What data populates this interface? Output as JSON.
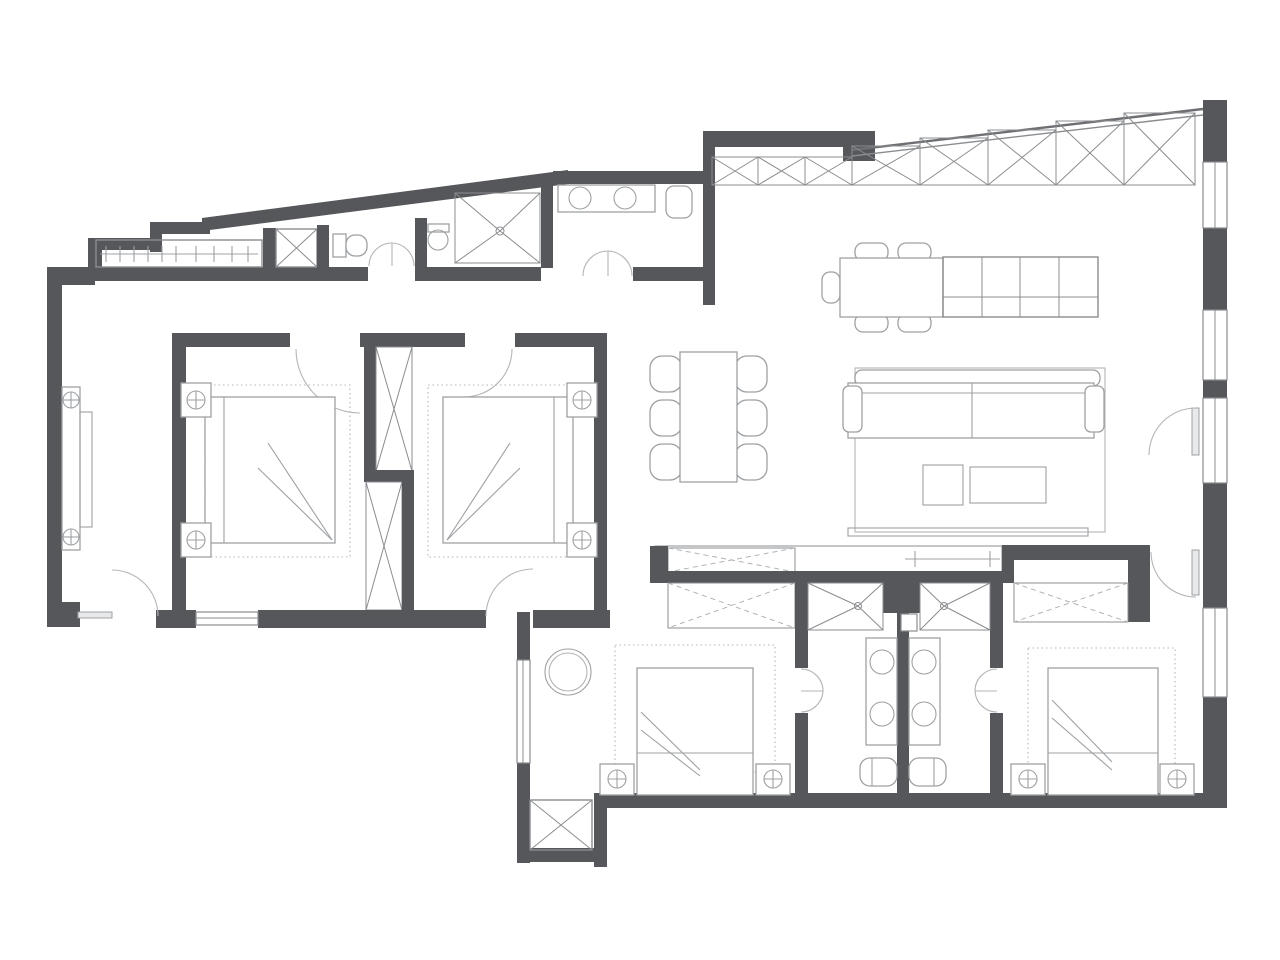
{
  "image": {
    "kind": "architectural-floor-plan",
    "width_px": 1280,
    "height_px": 960,
    "style": "black-and-white line drawing, top-down apartment plan, no text labels"
  },
  "colors": {
    "bg": "#ffffff",
    "wall": "#56575b",
    "line": "#8a8c8f",
    "furn": "#9da0a3",
    "faint": "#b3b5b8",
    "dash": "#b0b2b5"
  },
  "elements": {
    "rooms": [
      "entry-hall-with-coat-closet",
      "utility-shaft",
      "guest-wc",
      "shower-room",
      "top-bathroom",
      "open-kitchen-living-dining-area",
      "bedroom-1-left",
      "bedroom-2-left",
      "wardrobe-corridor",
      "ensuite-bathroom-left",
      "ensuite-bathroom-right",
      "bedroom-bottom-left",
      "bedroom-bottom-right",
      "ac-platform"
    ],
    "furniture_symbols": [
      "coat-rail-with-hangers",
      "shaft-x-box",
      "toilet",
      "wall-basin",
      "shower-with-fan-lines",
      "double-basin-vanity",
      "kitchen-wall-cabinets-x-cells",
      "kitchen-island-grid",
      "kitchen-table-with-chairs",
      "dining-table-six-chairs",
      "three-seat-sofa",
      "rug",
      "coffee-tables",
      "tv-bench",
      "double-bed-with-nightstands-and-lamps",
      "dashed-x-wardrobes",
      "hanging-rail-with-ticks",
      "round-armchair",
      "window-bands",
      "door-swing-arcs",
      "double-swing-doors"
    ]
  }
}
